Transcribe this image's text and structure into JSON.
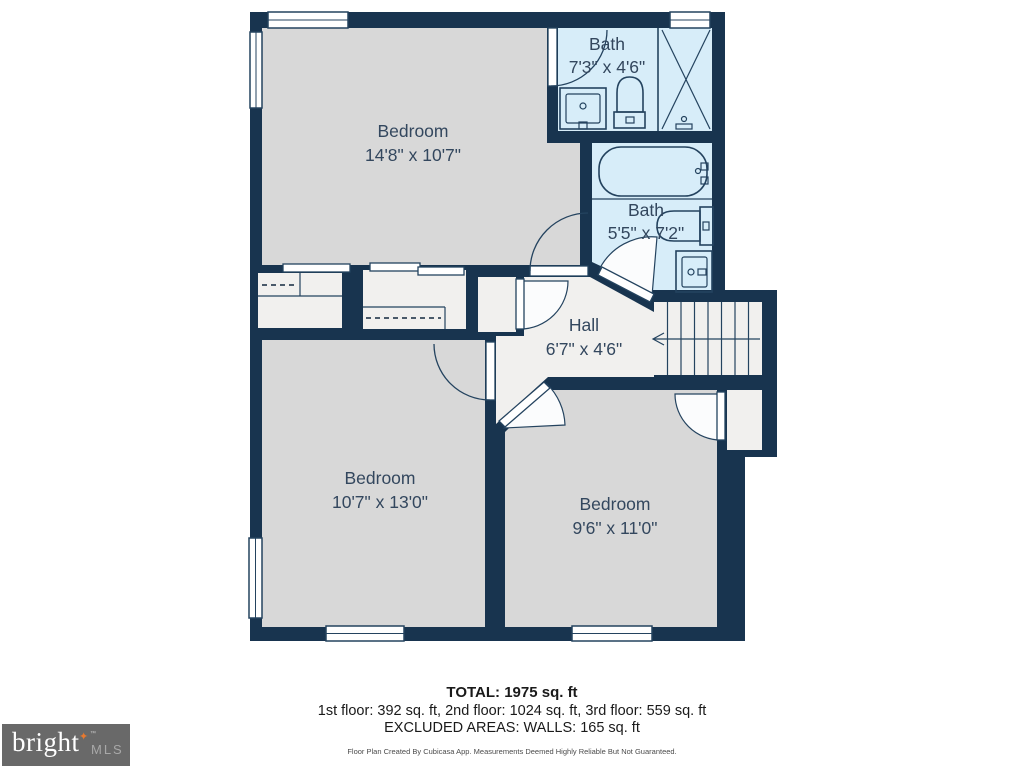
{
  "plan": {
    "rooms": [
      {
        "id": "bedroom-top-left",
        "name": "Bedroom",
        "dims": "14'8\" x 10'7\""
      },
      {
        "id": "bath-top",
        "name": "Bath",
        "dims": "7'3\" x 4'6\""
      },
      {
        "id": "bath-middle",
        "name": "Bath",
        "dims": "5'5\" x 7'2\""
      },
      {
        "id": "hall",
        "name": "Hall",
        "dims": "6'7\" x 4'6\""
      },
      {
        "id": "bedroom-bottom-left",
        "name": "Bedroom",
        "dims": "10'7\" x 13'0\""
      },
      {
        "id": "bedroom-bottom-right",
        "name": "Bedroom",
        "dims": "9'6\" x 11'0\""
      }
    ],
    "features": [
      "stairs-with-down-arrow",
      "closets-with-hanging-rails",
      "bathtub",
      "shower",
      "toilets",
      "sink-vanities",
      "hinged-doors",
      "sliding-closet-doors",
      "windows"
    ]
  },
  "summary": {
    "total": "TOTAL: 1975 sq. ft",
    "floors": "1st floor: 392 sq. ft, 2nd floor: 1024 sq. ft, 3rd floor: 559 sq. ft",
    "excluded": "EXCLUDED AREAS: WALLS: 165 sq. ft",
    "disclaimer": "Floor Plan Created By Cubicasa App. Measurements Deemed Highly Reliable But Not Guaranteed."
  },
  "logo": {
    "brand": "bright",
    "star": "✦",
    "tm": "™",
    "suffix": "MLS"
  },
  "colors": {
    "wall": "#18344f",
    "bedroom_fill": "#d8d8d8",
    "bath_fill": "#d7edf9",
    "hall_fill": "#f1f0ee",
    "logo_background": "#696969",
    "logo_star": "#e8792f"
  }
}
